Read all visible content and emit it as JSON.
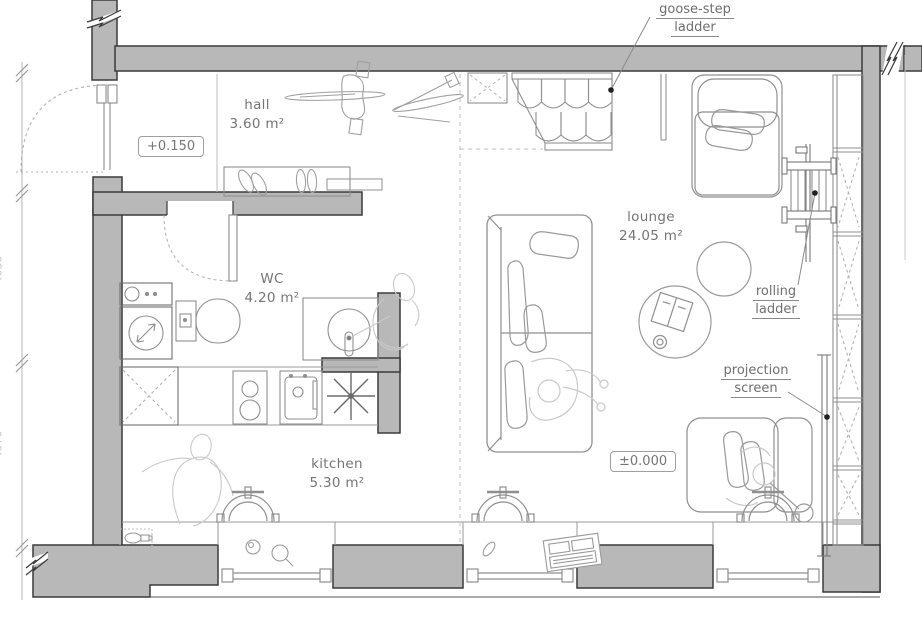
{
  "floorplan": {
    "rooms": [
      {
        "name": "hall",
        "area": "3.60 m²"
      },
      {
        "name": "WC",
        "area": "4.20 m²"
      },
      {
        "name": "kitchen",
        "area": "5.30 m²"
      },
      {
        "name": "lounge",
        "area": "24.05 m²"
      }
    ],
    "elevation_markers": [
      {
        "value": "+0.150"
      },
      {
        "value": "±0.000"
      }
    ],
    "callouts": [
      {
        "line1": "goose-step",
        "line2": "ladder"
      },
      {
        "line1": "rolling",
        "line2": "ladder"
      },
      {
        "line1": "projection",
        "line2": "screen"
      }
    ],
    "dimensions": [
      {
        "value": "4030"
      },
      {
        "value": "4970"
      }
    ],
    "colors": {
      "wall_fill": "#b8b8b8",
      "wall_stroke": "#3a3a3a",
      "furniture_line": "#8f8f8f",
      "faint_figure": "#c9c9c9",
      "label_text": "#757575",
      "leader_dot": "#1f1f1f"
    }
  }
}
